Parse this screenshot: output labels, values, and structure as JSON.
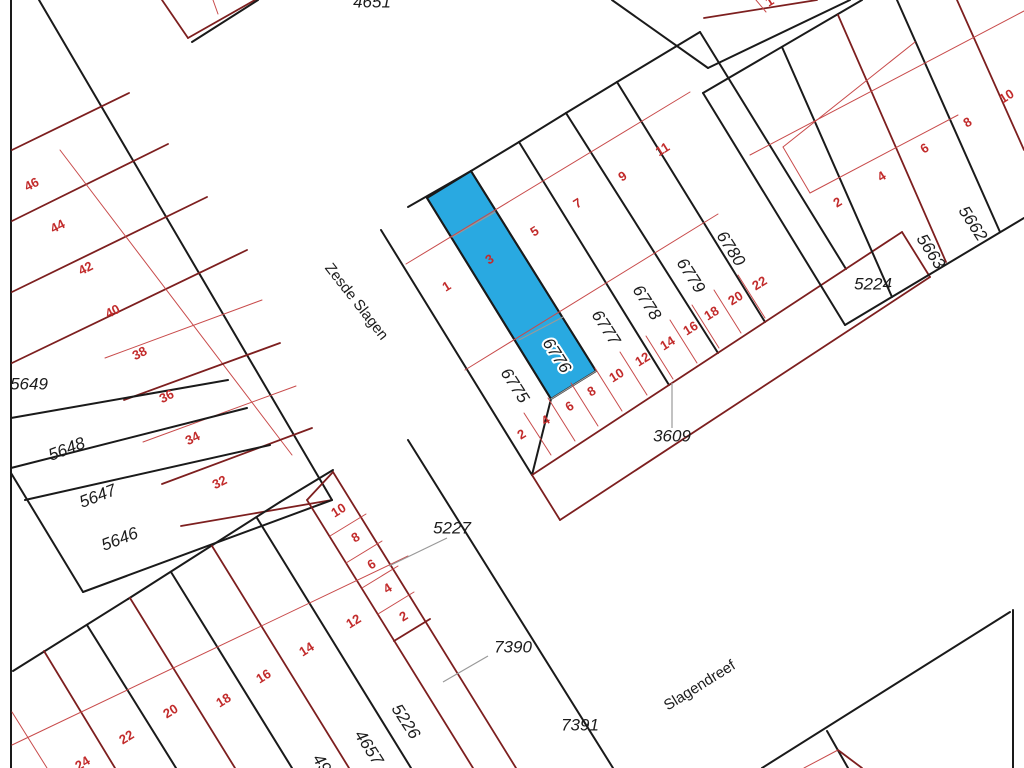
{
  "canvas": {
    "width": 1024,
    "height": 768,
    "background": "#ffffff"
  },
  "colors": {
    "line_black": "#1a1a1a",
    "line_darkred": "#7d1f1f",
    "line_thinred": "#c84b4b",
    "line_grey": "#999999",
    "label_black": "#1c1c1c",
    "label_red": "#c22b2b",
    "highlight_fill": "#29a9e1"
  },
  "highlighted_parcel": {
    "number": "6776",
    "points": "427,198 471,171 596,371 551,399",
    "label": {
      "text": "6776",
      "x": 556,
      "y": 356,
      "rot": 57,
      "size": 17
    }
  },
  "street_names": [
    {
      "text": "Zesde Slagen",
      "x": 356,
      "y": 302,
      "rot": 52,
      "size": 15
    },
    {
      "text": "Slagendreef",
      "x": 700,
      "y": 686,
      "rot": -32,
      "size": 15
    }
  ],
  "parcel_labels": [
    {
      "text": "4651",
      "x": 372,
      "y": 3,
      "rot": 0,
      "size": 17
    },
    {
      "text": "5649",
      "x": 29,
      "y": 385,
      "rot": 0,
      "size": 17
    },
    {
      "text": "5648",
      "x": 67,
      "y": 450,
      "rot": -21,
      "size": 17
    },
    {
      "text": "5647",
      "x": 98,
      "y": 497,
      "rot": -21,
      "size": 17
    },
    {
      "text": "5646",
      "x": 120,
      "y": 540,
      "rot": -21,
      "size": 17
    },
    {
      "text": "6775",
      "x": 514,
      "y": 386,
      "rot": 57,
      "size": 17
    },
    {
      "text": "6777",
      "x": 605,
      "y": 328,
      "rot": 57,
      "size": 17
    },
    {
      "text": "6778",
      "x": 646,
      "y": 303,
      "rot": 57,
      "size": 17
    },
    {
      "text": "6779",
      "x": 690,
      "y": 276,
      "rot": 57,
      "size": 17
    },
    {
      "text": "6780",
      "x": 730,
      "y": 249,
      "rot": 57,
      "size": 17
    },
    {
      "text": "5224",
      "x": 873,
      "y": 285,
      "rot": 0,
      "size": 17
    },
    {
      "text": "5663",
      "x": 930,
      "y": 252,
      "rot": 57,
      "size": 17
    },
    {
      "text": "5662",
      "x": 972,
      "y": 224,
      "rot": 57,
      "size": 17
    },
    {
      "text": "3609",
      "x": 672,
      "y": 437,
      "rot": 0,
      "size": 17
    },
    {
      "text": "5227",
      "x": 452,
      "y": 529,
      "rot": 0,
      "size": 17
    },
    {
      "text": "7390",
      "x": 513,
      "y": 648,
      "rot": 0,
      "size": 17
    },
    {
      "text": "7391",
      "x": 580,
      "y": 726,
      "rot": 0,
      "size": 17
    },
    {
      "text": "5226",
      "x": 405,
      "y": 722,
      "rot": 57,
      "size": 17
    },
    {
      "text": "4657",
      "x": 368,
      "y": 748,
      "rot": 57,
      "size": 17
    },
    {
      "text": "49",
      "x": 321,
      "y": 764,
      "rot": 57,
      "size": 17
    }
  ],
  "house_numbers": [
    {
      "text": "46",
      "x": 32,
      "y": 185,
      "rot": -27
    },
    {
      "text": "44",
      "x": 58,
      "y": 227,
      "rot": -27
    },
    {
      "text": "42",
      "x": 86,
      "y": 269,
      "rot": -27
    },
    {
      "text": "40",
      "x": 113,
      "y": 312,
      "rot": -27
    },
    {
      "text": "38",
      "x": 140,
      "y": 354,
      "rot": -27
    },
    {
      "text": "36",
      "x": 167,
      "y": 397,
      "rot": -27
    },
    {
      "text": "34",
      "x": 193,
      "y": 439,
      "rot": -27
    },
    {
      "text": "32",
      "x": 220,
      "y": 483,
      "rot": -27
    },
    {
      "text": "1",
      "x": 447,
      "y": 287,
      "rot": -32
    },
    {
      "text": "3",
      "x": 490,
      "y": 260,
      "rot": -32
    },
    {
      "text": "5",
      "x": 535,
      "y": 232,
      "rot": -32
    },
    {
      "text": "7",
      "x": 578,
      "y": 204,
      "rot": -32
    },
    {
      "text": "9",
      "x": 623,
      "y": 177,
      "rot": -32
    },
    {
      "text": "11",
      "x": 663,
      "y": 150,
      "rot": -32
    },
    {
      "text": "2",
      "x": 522,
      "y": 435,
      "rot": -32
    },
    {
      "text": "4",
      "x": 546,
      "y": 421,
      "rot": -32
    },
    {
      "text": "6",
      "x": 570,
      "y": 407,
      "rot": -32
    },
    {
      "text": "8",
      "x": 592,
      "y": 392,
      "rot": -32
    },
    {
      "text": "10",
      "x": 617,
      "y": 376,
      "rot": -32
    },
    {
      "text": "12",
      "x": 643,
      "y": 360,
      "rot": -32
    },
    {
      "text": "14",
      "x": 668,
      "y": 344,
      "rot": -32
    },
    {
      "text": "16",
      "x": 691,
      "y": 329,
      "rot": -32
    },
    {
      "text": "18",
      "x": 712,
      "y": 314,
      "rot": -32
    },
    {
      "text": "20",
      "x": 736,
      "y": 299,
      "rot": -32
    },
    {
      "text": "22",
      "x": 760,
      "y": 284,
      "rot": -32
    },
    {
      "text": "2",
      "x": 838,
      "y": 203,
      "rot": -32
    },
    {
      "text": "4",
      "x": 882,
      "y": 177,
      "rot": -32
    },
    {
      "text": "6",
      "x": 925,
      "y": 149,
      "rot": -32
    },
    {
      "text": "8",
      "x": 968,
      "y": 123,
      "rot": -32
    },
    {
      "text": "10",
      "x": 1007,
      "y": 97,
      "rot": -32
    },
    {
      "text": "24",
      "x": 83,
      "y": 764,
      "rot": -32
    },
    {
      "text": "22",
      "x": 127,
      "y": 738,
      "rot": -32
    },
    {
      "text": "20",
      "x": 171,
      "y": 712,
      "rot": -32
    },
    {
      "text": "18",
      "x": 224,
      "y": 701,
      "rot": -32
    },
    {
      "text": "16",
      "x": 264,
      "y": 677,
      "rot": -32
    },
    {
      "text": "14",
      "x": 307,
      "y": 650,
      "rot": -32
    },
    {
      "text": "12",
      "x": 354,
      "y": 622,
      "rot": -32
    },
    {
      "text": "10",
      "x": 339,
      "y": 511,
      "rot": -32
    },
    {
      "text": "8",
      "x": 356,
      "y": 538,
      "rot": -32
    },
    {
      "text": "6",
      "x": 372,
      "y": 565,
      "rot": -32
    },
    {
      "text": "4",
      "x": 388,
      "y": 589,
      "rot": -32
    },
    {
      "text": "2",
      "x": 404,
      "y": 617,
      "rot": -32
    },
    {
      "text": "1",
      "x": 770,
      "y": 2,
      "rot": -32
    }
  ],
  "leader_lines": [
    {
      "x1": 672,
      "y1": 383,
      "x2": 672,
      "y2": 428
    },
    {
      "x1": 447,
      "y1": 538,
      "x2": 389,
      "y2": 566
    },
    {
      "x1": 488,
      "y1": 656,
      "x2": 443,
      "y2": 682
    }
  ],
  "lines": [
    {
      "x1": 11,
      "y1": 0,
      "x2": 11,
      "y2": 768,
      "c": "k"
    },
    {
      "x1": 39,
      "y1": 0,
      "x2": 332,
      "y2": 500,
      "c": "k"
    },
    {
      "x1": 12,
      "y1": 150,
      "x2": 129,
      "y2": 93,
      "c": "d"
    },
    {
      "x1": 12,
      "y1": 221,
      "x2": 168,
      "y2": 144,
      "c": "d"
    },
    {
      "x1": 12,
      "y1": 292,
      "x2": 207,
      "y2": 197,
      "c": "d"
    },
    {
      "x1": 12,
      "y1": 363,
      "x2": 247,
      "y2": 250,
      "c": "d"
    },
    {
      "x1": 60,
      "y1": 150,
      "x2": 292,
      "y2": 455,
      "c": "r"
    },
    {
      "x1": 105,
      "y1": 358,
      "x2": 262,
      "y2": 300,
      "c": "r"
    },
    {
      "x1": 124,
      "y1": 400,
      "x2": 280,
      "y2": 343,
      "c": "d"
    },
    {
      "x1": 143,
      "y1": 442,
      "x2": 296,
      "y2": 386,
      "c": "r"
    },
    {
      "x1": 162,
      "y1": 484,
      "x2": 312,
      "y2": 428,
      "c": "d"
    },
    {
      "x1": 181,
      "y1": 526,
      "x2": 332,
      "y2": 500,
      "c": "d"
    },
    {
      "x1": 11,
      "y1": 418,
      "x2": 228,
      "y2": 380,
      "c": "k"
    },
    {
      "x1": 11,
      "y1": 468,
      "x2": 247,
      "y2": 408,
      "c": "k"
    },
    {
      "x1": 25,
      "y1": 500,
      "x2": 270,
      "y2": 445,
      "c": "k"
    },
    {
      "x1": 11,
      "y1": 473,
      "x2": 83,
      "y2": 592,
      "c": "k"
    },
    {
      "x1": 83,
      "y1": 592,
      "x2": 332,
      "y2": 500,
      "c": "k"
    },
    {
      "x1": 162,
      "y1": 0,
      "x2": 188,
      "y2": 38,
      "c": "d"
    },
    {
      "x1": 188,
      "y1": 38,
      "x2": 255,
      "y2": 0,
      "c": "d"
    },
    {
      "x1": 213,
      "y1": 0,
      "x2": 218,
      "y2": 14,
      "c": "r"
    },
    {
      "x1": 192,
      "y1": 42,
      "x2": 258,
      "y2": 0,
      "c": "k"
    },
    {
      "x1": 612,
      "y1": 0,
      "x2": 708,
      "y2": 68,
      "c": "k"
    },
    {
      "x1": 708,
      "y1": 68,
      "x2": 850,
      "y2": 0,
      "c": "k"
    },
    {
      "x1": 704,
      "y1": 18,
      "x2": 817,
      "y2": 0,
      "c": "d"
    },
    {
      "x1": 756,
      "y1": 0,
      "x2": 766,
      "y2": 12,
      "c": "r"
    },
    {
      "x1": 408,
      "y1": 207,
      "x2": 471,
      "y2": 171,
      "c": "k"
    },
    {
      "x1": 471,
      "y1": 171,
      "x2": 519,
      "y2": 142,
      "c": "k"
    },
    {
      "x1": 519,
      "y1": 142,
      "x2": 566,
      "y2": 113,
      "c": "k"
    },
    {
      "x1": 566,
      "y1": 113,
      "x2": 617,
      "y2": 82,
      "c": "k"
    },
    {
      "x1": 617,
      "y1": 82,
      "x2": 700,
      "y2": 32,
      "c": "k"
    },
    {
      "x1": 381,
      "y1": 230,
      "x2": 532,
      "y2": 475,
      "c": "k"
    },
    {
      "x1": 700,
      "y1": 32,
      "x2": 846,
      "y2": 269,
      "c": "k"
    },
    {
      "x1": 427,
      "y1": 198,
      "x2": 551,
      "y2": 399,
      "c": "k"
    },
    {
      "x1": 471,
      "y1": 171,
      "x2": 596,
      "y2": 371,
      "c": "k"
    },
    {
      "x1": 519,
      "y1": 142,
      "x2": 669,
      "y2": 385,
      "c": "k"
    },
    {
      "x1": 566,
      "y1": 113,
      "x2": 718,
      "y2": 353,
      "c": "k"
    },
    {
      "x1": 617,
      "y1": 82,
      "x2": 765,
      "y2": 322,
      "c": "k"
    },
    {
      "x1": 551,
      "y1": 399,
      "x2": 532,
      "y2": 475,
      "c": "k"
    },
    {
      "x1": 551,
      "y1": 399,
      "x2": 596,
      "y2": 371,
      "c": "g"
    },
    {
      "x1": 452,
      "y1": 237,
      "x2": 495,
      "y2": 212,
      "c": "g"
    },
    {
      "x1": 519,
      "y1": 340,
      "x2": 563,
      "y2": 317,
      "c": "g"
    },
    {
      "x1": 406,
      "y1": 264,
      "x2": 690,
      "y2": 92,
      "c": "r"
    },
    {
      "x1": 465,
      "y1": 370,
      "x2": 718,
      "y2": 214,
      "c": "r"
    },
    {
      "x1": 532,
      "y1": 475,
      "x2": 902,
      "y2": 232,
      "c": "d"
    },
    {
      "x1": 902,
      "y1": 232,
      "x2": 930,
      "y2": 277,
      "c": "d"
    },
    {
      "x1": 560,
      "y1": 520,
      "x2": 930,
      "y2": 277,
      "c": "d"
    },
    {
      "x1": 532,
      "y1": 475,
      "x2": 560,
      "y2": 520,
      "c": "d"
    },
    {
      "x1": 524,
      "y1": 413,
      "x2": 551,
      "y2": 455,
      "c": "r"
    },
    {
      "x1": 548,
      "y1": 398,
      "x2": 575,
      "y2": 441,
      "c": "r"
    },
    {
      "x1": 571,
      "y1": 383,
      "x2": 598,
      "y2": 426,
      "c": "r"
    },
    {
      "x1": 595,
      "y1": 368,
      "x2": 622,
      "y2": 411,
      "c": "r"
    },
    {
      "x1": 620,
      "y1": 352,
      "x2": 647,
      "y2": 395,
      "c": "r"
    },
    {
      "x1": 646,
      "y1": 336,
      "x2": 673,
      "y2": 379,
      "c": "r"
    },
    {
      "x1": 670,
      "y1": 320,
      "x2": 697,
      "y2": 363,
      "c": "r"
    },
    {
      "x1": 692,
      "y1": 305,
      "x2": 719,
      "y2": 348,
      "c": "r"
    },
    {
      "x1": 714,
      "y1": 290,
      "x2": 741,
      "y2": 333,
      "c": "r"
    },
    {
      "x1": 738,
      "y1": 275,
      "x2": 765,
      "y2": 318,
      "c": "r"
    },
    {
      "x1": 703,
      "y1": 93,
      "x2": 862,
      "y2": 0,
      "c": "k"
    },
    {
      "x1": 703,
      "y1": 93,
      "x2": 845,
      "y2": 325,
      "c": "k"
    },
    {
      "x1": 845,
      "y1": 325,
      "x2": 1024,
      "y2": 218,
      "c": "k"
    },
    {
      "x1": 782,
      "y1": 47,
      "x2": 892,
      "y2": 297,
      "c": "k"
    },
    {
      "x1": 838,
      "y1": 15,
      "x2": 946,
      "y2": 262,
      "c": "d"
    },
    {
      "x1": 897,
      "y1": 0,
      "x2": 1000,
      "y2": 232,
      "c": "k"
    },
    {
      "x1": 957,
      "y1": 0,
      "x2": 1024,
      "y2": 150,
      "c": "d"
    },
    {
      "x1": 750,
      "y1": 155,
      "x2": 1024,
      "y2": 11,
      "c": "r"
    },
    {
      "x1": 783,
      "y1": 147,
      "x2": 915,
      "y2": 42,
      "c": "r"
    },
    {
      "x1": 783,
      "y1": 147,
      "x2": 810,
      "y2": 193,
      "c": "r"
    },
    {
      "x1": 810,
      "y1": 193,
      "x2": 958,
      "y2": 115,
      "c": "r"
    },
    {
      "x1": 13,
      "y1": 671,
      "x2": 128,
      "y2": 599,
      "c": "k"
    },
    {
      "x1": 128,
      "y1": 599,
      "x2": 280,
      "y2": 502,
      "c": "k"
    },
    {
      "x1": 280,
      "y1": 502,
      "x2": 333,
      "y2": 470,
      "c": "k"
    },
    {
      "x1": 307,
      "y1": 500,
      "x2": 473,
      "y2": 768,
      "c": "d"
    },
    {
      "x1": 307,
      "y1": 500,
      "x2": 333,
      "y2": 472,
      "c": "d"
    },
    {
      "x1": 333,
      "y1": 472,
      "x2": 516,
      "y2": 768,
      "c": "d"
    },
    {
      "x1": 408,
      "y1": 440,
      "x2": 613,
      "y2": 768,
      "c": "k"
    },
    {
      "x1": 257,
      "y1": 518,
      "x2": 411,
      "y2": 768,
      "c": "k"
    },
    {
      "x1": 212,
      "y1": 546,
      "x2": 349,
      "y2": 768,
      "c": "d"
    },
    {
      "x1": 171,
      "y1": 572,
      "x2": 292,
      "y2": 768,
      "c": "k"
    },
    {
      "x1": 130,
      "y1": 598,
      "x2": 235,
      "y2": 768,
      "c": "d"
    },
    {
      "x1": 87,
      "y1": 625,
      "x2": 176,
      "y2": 768,
      "c": "k"
    },
    {
      "x1": 44,
      "y1": 651,
      "x2": 115,
      "y2": 768,
      "c": "d"
    },
    {
      "x1": 12,
      "y1": 712,
      "x2": 47,
      "y2": 768,
      "c": "r"
    },
    {
      "x1": 12,
      "y1": 745,
      "x2": 408,
      "y2": 556,
      "c": "r"
    },
    {
      "x1": 330,
      "y1": 536,
      "x2": 366,
      "y2": 514,
      "c": "r"
    },
    {
      "x1": 346,
      "y1": 563,
      "x2": 382,
      "y2": 541,
      "c": "r"
    },
    {
      "x1": 362,
      "y1": 588,
      "x2": 398,
      "y2": 566,
      "c": "r"
    },
    {
      "x1": 378,
      "y1": 614,
      "x2": 414,
      "y2": 592,
      "c": "r"
    },
    {
      "x1": 394,
      "y1": 641,
      "x2": 430,
      "y2": 619,
      "c": "d"
    },
    {
      "x1": 762,
      "y1": 768,
      "x2": 1010,
      "y2": 612,
      "c": "k"
    },
    {
      "x1": 1013,
      "y1": 610,
      "x2": 1013,
      "y2": 768,
      "c": "k"
    },
    {
      "x1": 827,
      "y1": 731,
      "x2": 848,
      "y2": 768,
      "c": "k"
    },
    {
      "x1": 804,
      "y1": 768,
      "x2": 838,
      "y2": 750,
      "c": "r"
    },
    {
      "x1": 838,
      "y1": 750,
      "x2": 862,
      "y2": 768,
      "c": "d"
    }
  ]
}
